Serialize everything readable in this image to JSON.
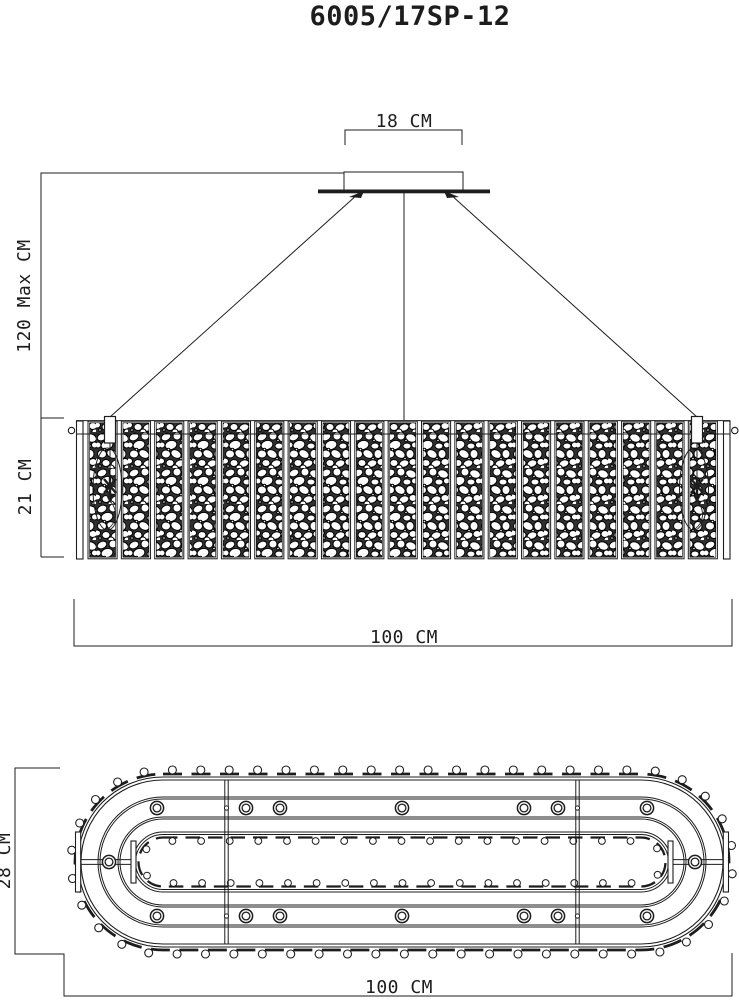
{
  "title": "6005/17SP-12",
  "front_view": {
    "dim_canopy_width": "18 CM",
    "dim_max_height": "120 Max CM",
    "dim_body_height": "21 CM",
    "dim_width": "100 CM",
    "panel_count": 19
  },
  "plan_view": {
    "dim_depth": "28 CM",
    "dim_width": "100 CM",
    "lamp_count": 16,
    "lamp_row_count": 7
  },
  "colors": {
    "line": "#1d1d1d",
    "background": "#ffffff",
    "panel_fill": "#303030"
  }
}
